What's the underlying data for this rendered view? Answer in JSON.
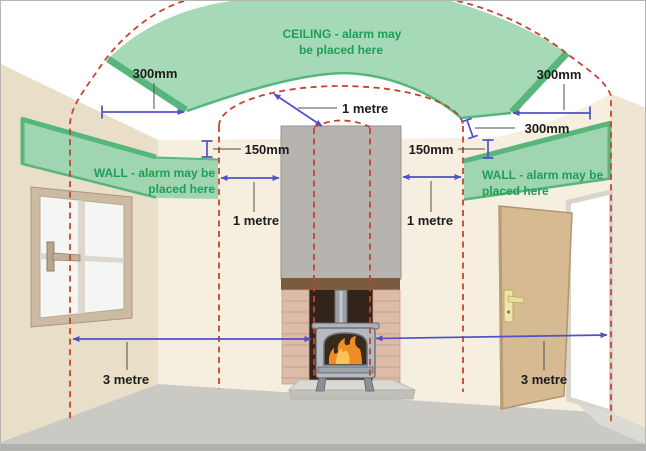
{
  "diagram": {
    "ceiling_zone": {
      "line1": "CEILING - alarm may",
      "line2": "be placed here"
    },
    "left_wall_zone": {
      "line1": "WALL - alarm may be",
      "line2": "placed here"
    },
    "right_wall_zone": {
      "line1": "WALL - alarm may be",
      "line2": "placed here"
    },
    "measurements": {
      "ceiling_left_300mm": "300mm",
      "ceiling_right_300mm": "300mm",
      "cove_right_300mm": "300mm",
      "left_150mm": "150mm",
      "right_150mm": "150mm",
      "flue_radius_1m": "1 metre",
      "left_wall_1m": "1 metre",
      "right_wall_1m": "1 metre",
      "left_floor_3m": "3 metre",
      "right_floor_3m": "3 metre"
    },
    "colors": {
      "zone_green": "#a6d9b7",
      "zone_green_dark": "#58b57c",
      "zone_text_green": "#1f9e58",
      "exclusion_red": "#c7432e",
      "measure_blue": "#5250c9"
    }
  }
}
